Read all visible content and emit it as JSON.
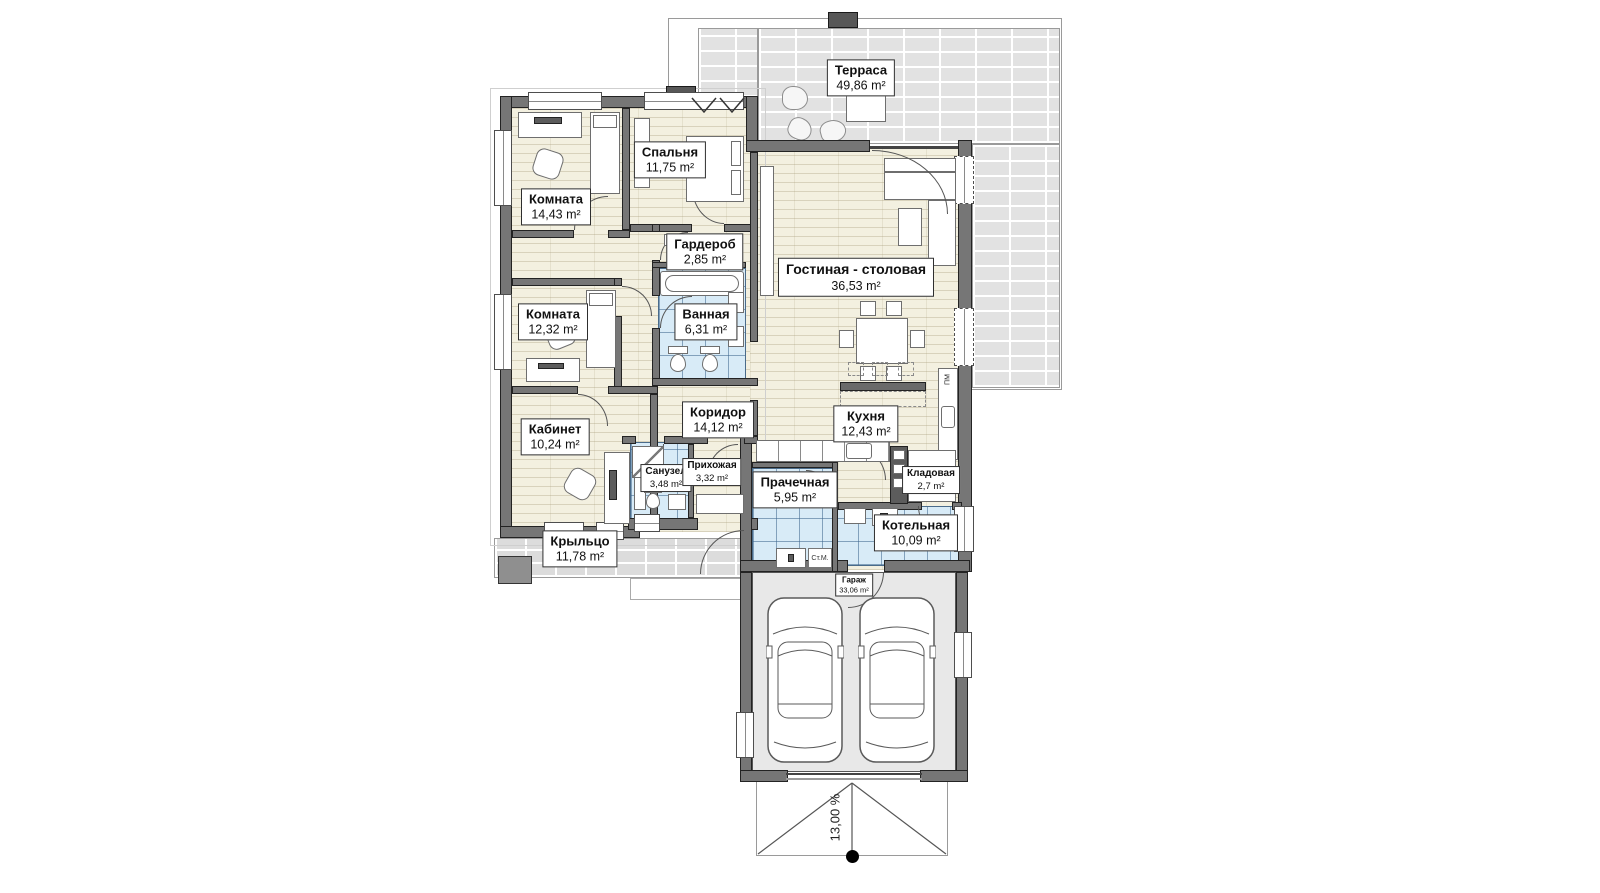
{
  "rooms": {
    "terrace": {
      "name": "Терраса",
      "area": "49,86 m²"
    },
    "room1": {
      "name": "Комната",
      "area": "14,43 m²"
    },
    "bedroom": {
      "name": "Спальня",
      "area": "11,75 m²"
    },
    "wardrobe": {
      "name": "Гардероб",
      "area": "2,85 m²"
    },
    "room2": {
      "name": "Комната",
      "area": "12,32 m²"
    },
    "bathroom": {
      "name": "Ванная",
      "area": "6,31 m²"
    },
    "living": {
      "name": "Гостиная - столовая",
      "area": "36,53 m²"
    },
    "kitchen": {
      "name": "Кухня",
      "area": "12,43 m²"
    },
    "corridor": {
      "name": "Коридор",
      "area": "14,12 m²"
    },
    "office": {
      "name": "Кабинет",
      "area": "10,24 m²"
    },
    "wc": {
      "name": "Санузел",
      "area": "3,48 m²"
    },
    "hall": {
      "name": "Прихожая",
      "area": "3,32 m²"
    },
    "laundry": {
      "name": "Прачечная",
      "area": "5,95 m²"
    },
    "pantry": {
      "name": "Кладовая",
      "area": "2,7 m²"
    },
    "boiler": {
      "name": "Котельная",
      "area": "10,09 m²"
    },
    "porch": {
      "name": "Крыльцо",
      "area": "11,78 m²"
    },
    "garage": {
      "name": "Гараж",
      "area": "33,06 m²"
    }
  },
  "annotations": {
    "slope": "13,00 %",
    "washer": "Ст.М.",
    "dishwasher": "ПМ"
  },
  "colors": {
    "wall": "#767676",
    "wood_floor": "#f3f0e0",
    "wet_tile": "#d8ebf7",
    "terrace_paving": "#e2e2e2",
    "garage_floor": "#e8e8e8"
  }
}
